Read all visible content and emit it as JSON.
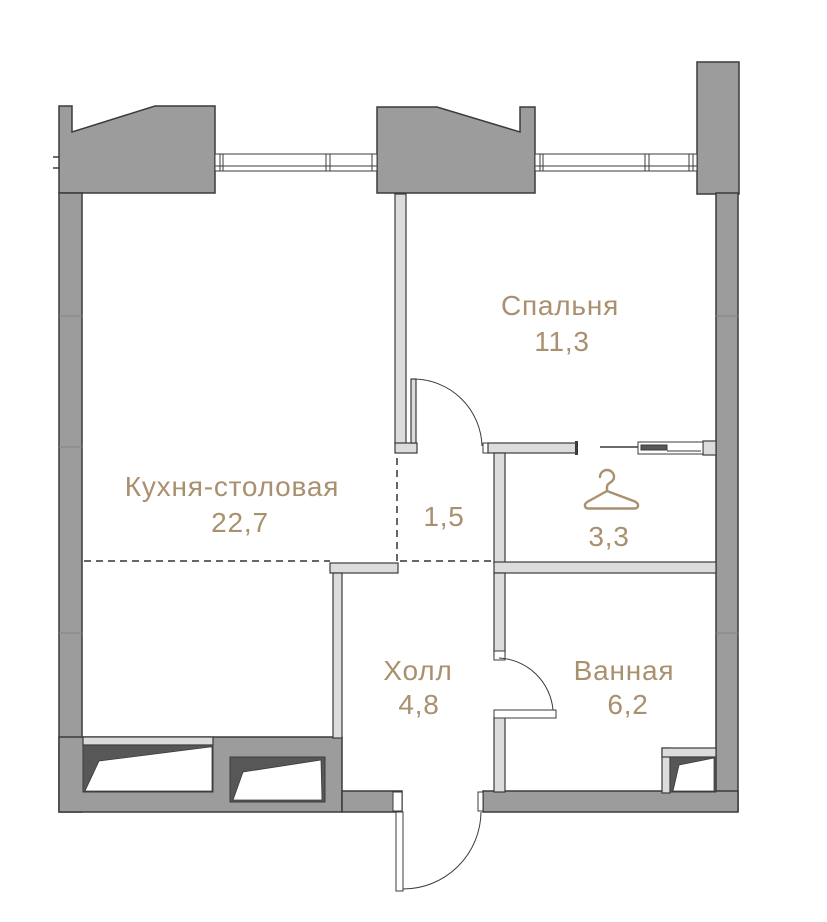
{
  "plan": {
    "rooms": {
      "bedroom": {
        "name": "Спальня",
        "area": "11,3"
      },
      "kitchen": {
        "name": "Кухня-столовая",
        "area": "22,7"
      },
      "corridor": {
        "area": "1,5"
      },
      "wardrobe": {
        "area": "3,3",
        "icon": "hanger-icon"
      },
      "hall": {
        "name": "Холл",
        "area": "4,8"
      },
      "bathroom": {
        "name": "Ванная",
        "area": "6,2"
      }
    },
    "colors": {
      "wall_fill": "#9c9c9c",
      "partition_fill": "#dcdcdc",
      "outline": "#3b3b3b",
      "label_text": "#a9906e",
      "window_shadow": "#575757"
    }
  }
}
